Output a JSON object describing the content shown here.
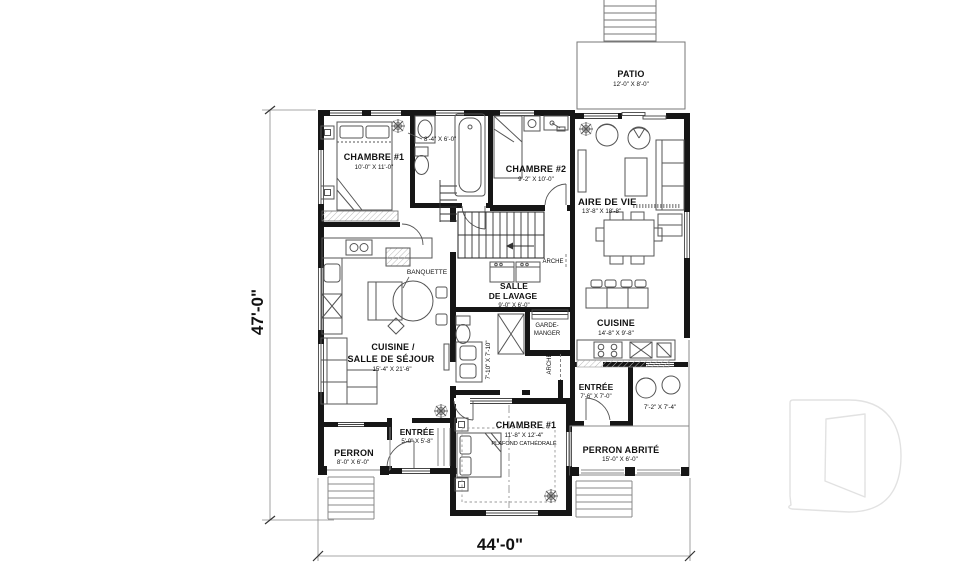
{
  "plan": {
    "overall_dimensions": {
      "width_label": "44'-0\"",
      "height_label": "47'-0\""
    },
    "rooms": {
      "patio": {
        "name": "PATIO",
        "dim": "12'-0\" X 8'-0\""
      },
      "chambre1_gauche": {
        "name": "CHAMBRE #1",
        "dim": "10'-0\" X 11'-0\""
      },
      "salle_de_bain_haut": {
        "dim": "8'-4\" X 6'-0\""
      },
      "chambre2": {
        "name": "CHAMBRE #2",
        "dim": "9'-2\" X 10'-0\""
      },
      "aire_de_vie": {
        "name": "AIRE DE VIE",
        "dim": "13'-8\" X 18'-8\""
      },
      "salle_de_lavage": {
        "name_line1": "SALLE",
        "name_line2": "DE LAVAGE",
        "dim": "9'-0\" X 6'-0\""
      },
      "arche_haut": {
        "name": "ARCHE"
      },
      "arche_bas": {
        "name": "ARCHE"
      },
      "garde_manger": {
        "name_line1": "GARDE-",
        "name_line2": "MANGER"
      },
      "banquette": {
        "name": "BANQUETTE"
      },
      "cuisine_salle_de_sejour": {
        "name_line1": "CUISINE /",
        "name_line2": "SALLE DE SÉJOUR",
        "dim": "15'-4\" X 21'-6\""
      },
      "salle_de_bain_centrale": {
        "dim": "7'-10\" X 7'-10\""
      },
      "cuisine_droite": {
        "name": "CUISINE",
        "dim": "14'-8\" X 9'-8\""
      },
      "entree_droite": {
        "name": "ENTRÉE",
        "dim": "7'-6\" X 7'-0\""
      },
      "coin_exterieur": {
        "dim": "7'-2\" X 7'-4\""
      },
      "entree_gauche": {
        "name": "ENTRÉE",
        "dim": "5'-0\" X 5'-8\""
      },
      "perron": {
        "name": "PERRON",
        "dim": "8'-0\" X 6'-0\""
      },
      "chambre1_bas": {
        "name": "CHAMBRE #1",
        "dim": "11'-8\" X 12'-4\"",
        "note": "PLAFOND CATHÉDRALE"
      },
      "perron_abrite": {
        "name": "PERRON ABRITÉ",
        "dim": "15'-0\" X 6'-0\""
      }
    },
    "watermark": {
      "icon": "letter-d-outline"
    },
    "colors": {
      "wall": "#161616",
      "text": "#111111",
      "watermark_stroke": "#e2e2e2"
    }
  }
}
